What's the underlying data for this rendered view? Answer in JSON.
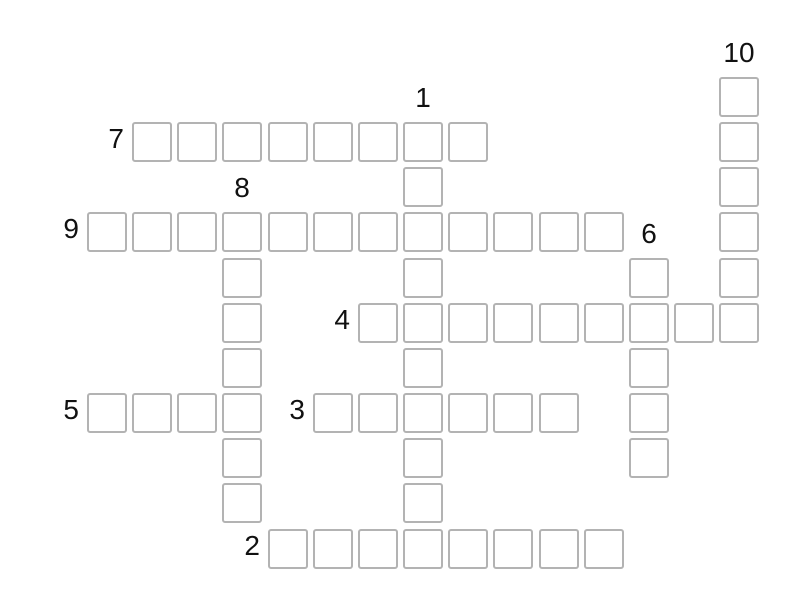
{
  "page": {
    "background": "#ffffff"
  },
  "puzzle": {
    "kind": "crossword",
    "cells_state": "empty"
  },
  "grid": {
    "origin_x": 87,
    "origin_y": 77,
    "pitch": 45.15,
    "cell_size": 40,
    "cell_border_color": "#b3b3b3",
    "cell_fill": "#ffffff",
    "label_color": "#111111"
  },
  "entries": [
    {
      "number": "1",
      "direction": "down",
      "row": 2,
      "col": 8,
      "length": 10
    },
    {
      "number": "2",
      "direction": "across",
      "row": 11,
      "col": 5,
      "length": 8
    },
    {
      "number": "3",
      "direction": "across",
      "row": 8,
      "col": 6,
      "length": 6
    },
    {
      "number": "4",
      "direction": "across",
      "row": 6,
      "col": 7,
      "length": 9
    },
    {
      "number": "5",
      "direction": "across",
      "row": 8,
      "col": 1,
      "length": 4
    },
    {
      "number": "6",
      "direction": "down",
      "row": 5,
      "col": 13,
      "length": 5
    },
    {
      "number": "7",
      "direction": "across",
      "row": 2,
      "col": 2,
      "length": 8
    },
    {
      "number": "8",
      "direction": "down",
      "row": 4,
      "col": 4,
      "length": 7
    },
    {
      "number": "9",
      "direction": "across",
      "row": 4,
      "col": 1,
      "length": 12
    },
    {
      "number": "10",
      "direction": "down",
      "row": 1,
      "col": 15,
      "length": 6
    }
  ]
}
